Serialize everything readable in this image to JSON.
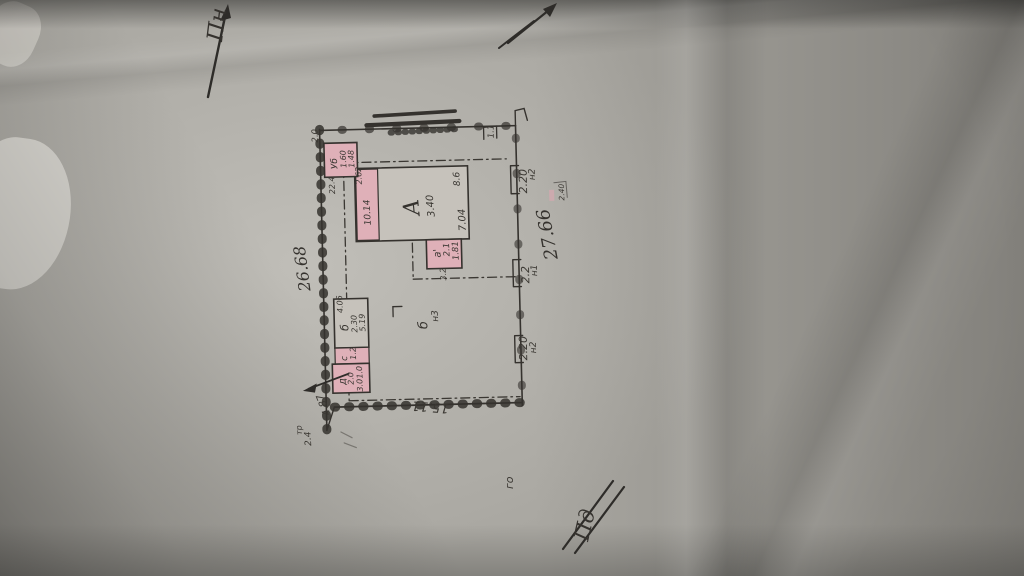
{
  "compass": {
    "north": "Пн",
    "south": "Пд"
  },
  "plan": {
    "dim_left": "26.68",
    "dim_right": "27.66",
    "dim_bottom": "15.11",
    "gate_top": {
      "id": "н2",
      "len": "2.20"
    },
    "gate_mid": {
      "id": "н1",
      "len": "2.2"
    },
    "gate_low": {
      "id": "н2",
      "len": "2.20"
    },
    "tick_topleft": "2.0",
    "tick_topright": "1.1",
    "gate_note": "2.40",
    "building_a": {
      "letter": "А",
      "num1": "3.40",
      "num2": "7.04",
      "num3": "8.6"
    },
    "annex": {
      "num1": "10.14",
      "num2": "2.62"
    },
    "porch": {
      "letter": "а'",
      "num1": "2.1",
      "num2": "1.81",
      "num3": "3.2"
    },
    "shed_u": {
      "letter": "Уб",
      "num1": "1.60",
      "num2": "1.48",
      "below": "22.4"
    },
    "shed_b": {
      "letter": "б",
      "num1": "2.30",
      "num2": "5.19",
      "num3": "4.06"
    },
    "shed_c": {
      "letter": "с",
      "num1": "1.2"
    },
    "shed_d": {
      "letter": "д",
      "num1": "2.0",
      "num2": "1.0",
      "num3": "3.0"
    },
    "well": {
      "letter": "б",
      "id": "н3"
    },
    "corner": {
      "dim": "4.87",
      "note": "тр",
      "len": "2.4"
    },
    "note_go": "го"
  },
  "colors": {
    "ink": "#35322e",
    "pink": "#dfb0b8",
    "paper": "#a9a7a1"
  }
}
